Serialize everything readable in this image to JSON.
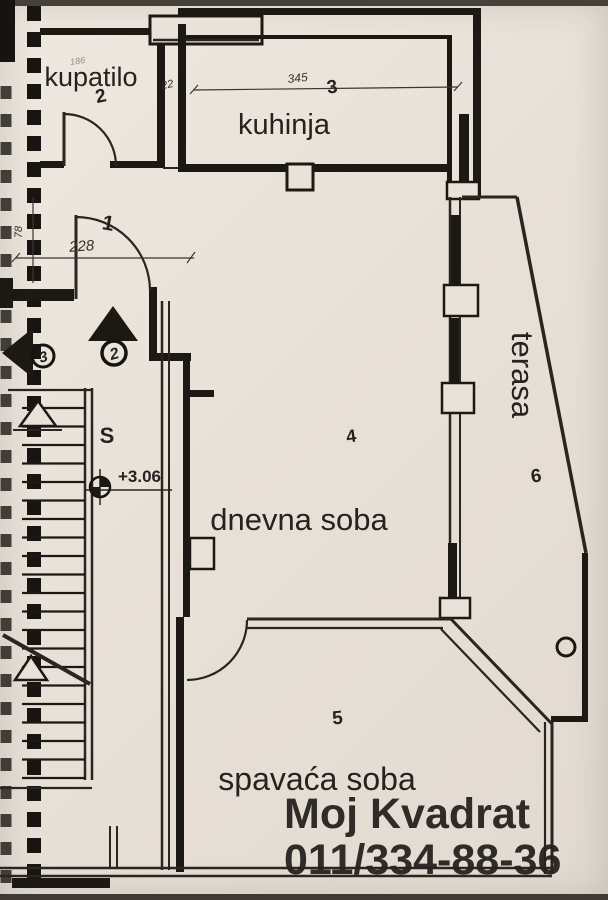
{
  "document": {
    "type": "floor-plan-photo",
    "language": "Serbian"
  },
  "labels": {
    "kupatilo": "kupatilo",
    "kuhinja": "kuhinja",
    "dnevna_soba": "dnevna soba",
    "spavaca_soba": "spavaća soba",
    "terasa": "terasa"
  },
  "room_numbers": {
    "hall": "1",
    "bathroom": "2",
    "kitchen": "3",
    "living_room": "4",
    "bedroom": "5",
    "terrace": "6"
  },
  "entry_markers": {
    "circled_up_arrow": "2",
    "circled_left_arrow": "3"
  },
  "dimensions": {
    "kitchen_width": "345",
    "hall_width": "228",
    "wall_gap": "22",
    "side_height": "78",
    "faint_small": "186"
  },
  "level_marker": {
    "value": "+3.06"
  },
  "stairs": {
    "label": "S"
  },
  "watermark": {
    "line1": "Moj Kvadrat",
    "line2": "011/334-88-36"
  },
  "colors": {
    "paper": "#e8e1d8",
    "ink": "#1c1813",
    "watermark_yellow": "#f1ea05"
  }
}
